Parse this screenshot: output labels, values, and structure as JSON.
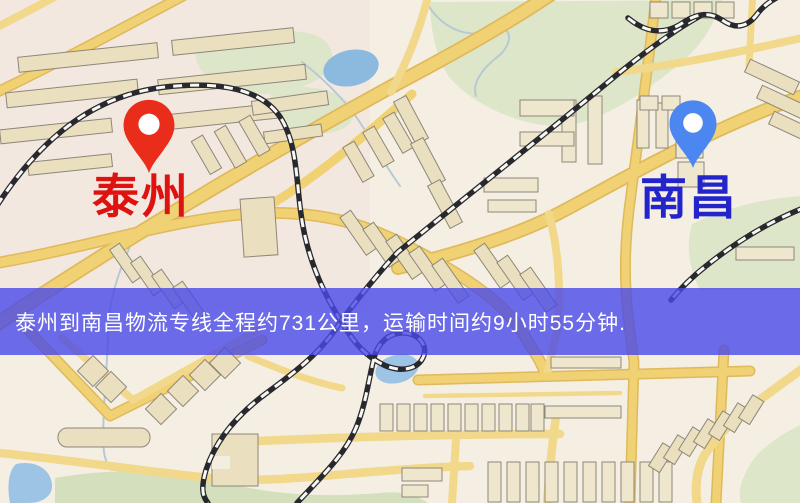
{
  "map": {
    "type": "static-route-map",
    "origin": {
      "label": "泰州",
      "label_color": "#df1212",
      "pin_color": "#ea2c1b",
      "pin": "red-pin"
    },
    "destination": {
      "label": "南昌",
      "label_color": "#2424cb",
      "pin_color": "#4c86f0",
      "pin": "blue-pin"
    },
    "banner": {
      "text": "泰州到南昌物流专线全程约731公里，运输时间约9小时55分钟.",
      "distance_text": "约731公里",
      "duration_text": "约9小时55分钟",
      "background": "rgba(73,73,233,0.8)",
      "text_color": "#ffffff"
    },
    "palette": {
      "background": "#f5efe3",
      "road": "#f0d173",
      "road_casing": "#dfb95c",
      "building": "#eadfbf",
      "building_outline": "#8d8779",
      "green_area": "#dde6c9",
      "water": "#8cbade",
      "railway_dark": "#28282f",
      "railway_light": "#f8f7f2"
    }
  }
}
